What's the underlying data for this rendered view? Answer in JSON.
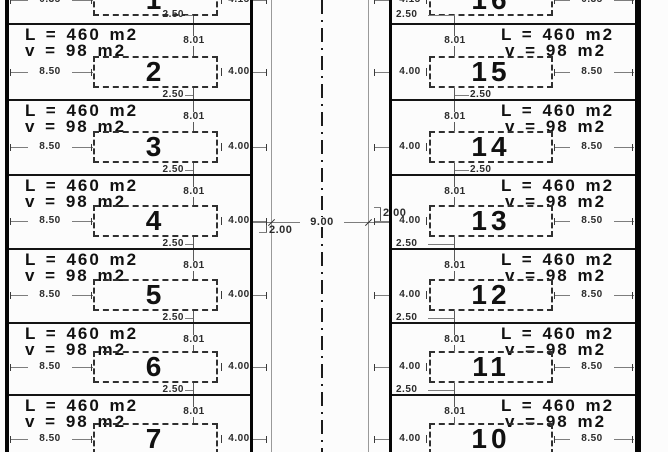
{
  "canvas": {
    "width": 668,
    "height": 452,
    "background": "#fcfcfc",
    "ink": "#141414",
    "dim_color": "#2b2b2b",
    "thin_color": "#9a9a9a"
  },
  "labels": {
    "area": "L = 460 m2",
    "veranda": "v = 98 m2",
    "depth": "8.01",
    "setback": "2.50",
    "frontage": "4.00",
    "side": "8.50"
  },
  "road": {
    "carriageway_width": "9.00",
    "sidewalk_left": "2.00",
    "sidewalk_right": "2.00"
  },
  "rows": [
    {
      "left_lot": "1",
      "right_lot": "16",
      "top": -49,
      "bottom": 27,
      "partial": "top",
      "side_dim": "0.35",
      "front_dim": "4.15",
      "right_setback_pos": "road"
    },
    {
      "left_lot": "2",
      "right_lot": "15",
      "top": 23,
      "bottom": 99,
      "right_setback_pos": "out"
    },
    {
      "left_lot": "3",
      "right_lot": "14",
      "top": 99,
      "bottom": 174,
      "right_setback_pos": "out"
    },
    {
      "left_lot": "4",
      "right_lot": "13",
      "top": 174,
      "bottom": 248,
      "right_setback_pos": "road"
    },
    {
      "left_lot": "5",
      "right_lot": "12",
      "top": 248,
      "bottom": 322,
      "right_setback_pos": "road"
    },
    {
      "left_lot": "6",
      "right_lot": "11",
      "top": 322,
      "bottom": 394,
      "right_setback_pos": "road"
    },
    {
      "left_lot": "7",
      "right_lot": "10",
      "top": 394,
      "bottom": 466,
      "partial": "bottom",
      "right_setback_pos": "road"
    }
  ],
  "layout": {
    "row_border_ys": [
      23,
      99,
      174,
      248,
      322,
      394
    ],
    "outer_left_x": 5,
    "outer_right_x": 635,
    "road_left_x": 250,
    "road_right_x": 389,
    "walk_left_x": 271,
    "walk_right_x": 368,
    "center_x": 322,
    "road_dim_y": 222
  }
}
